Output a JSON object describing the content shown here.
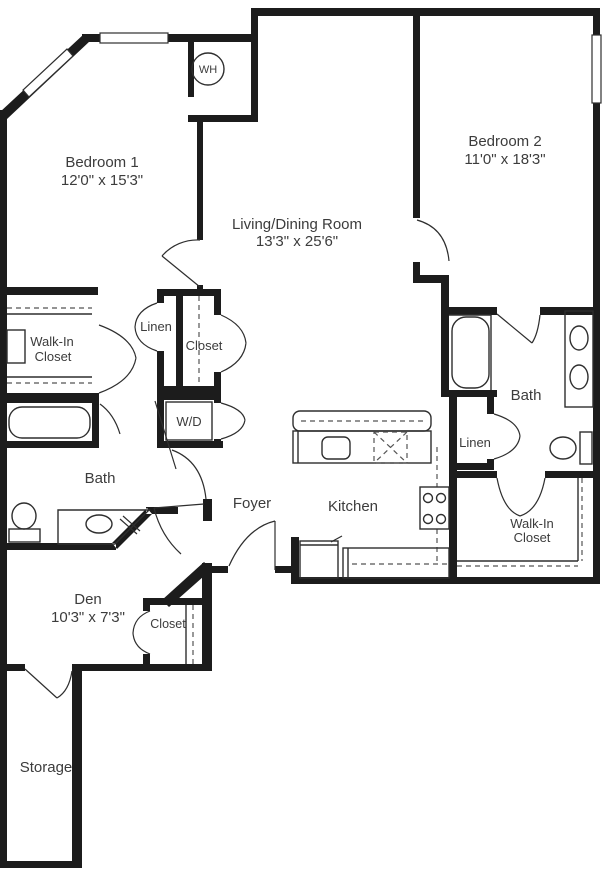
{
  "colors": {
    "wall": "#1c1c1c",
    "line": "#2e2e2e",
    "text": "#3c3c3c",
    "background": "#ffffff"
  },
  "rooms": {
    "bedroom1": {
      "label": "Bedroom 1",
      "dims": "12'0\" x 15'3\""
    },
    "bedroom2": {
      "label": "Bedroom 2",
      "dims": "11'0\" x 18'3\""
    },
    "living": {
      "label": "Living/Dining Room",
      "dims": "13'3\" x 25'6\""
    },
    "den": {
      "label": "Den",
      "dims": "10'3\" x 7'3\""
    },
    "kitchen": {
      "label": "Kitchen"
    },
    "foyer": {
      "label": "Foyer"
    },
    "bath1": {
      "label": "Bath"
    },
    "bath2": {
      "label": "Bath"
    },
    "storage": {
      "label": "Storage"
    },
    "walkin1": {
      "line1": "Walk-In",
      "line2": "Closet"
    },
    "walkin2": {
      "line1": "Walk-In",
      "line2": "Closet"
    },
    "linen1": {
      "label": "Linen"
    },
    "linen2": {
      "label": "Linen"
    },
    "closet1": {
      "label": "Closet"
    },
    "closetDen": {
      "label": "Closet"
    },
    "wd": {
      "label": "W/D"
    },
    "wh": {
      "label": "WH"
    }
  }
}
